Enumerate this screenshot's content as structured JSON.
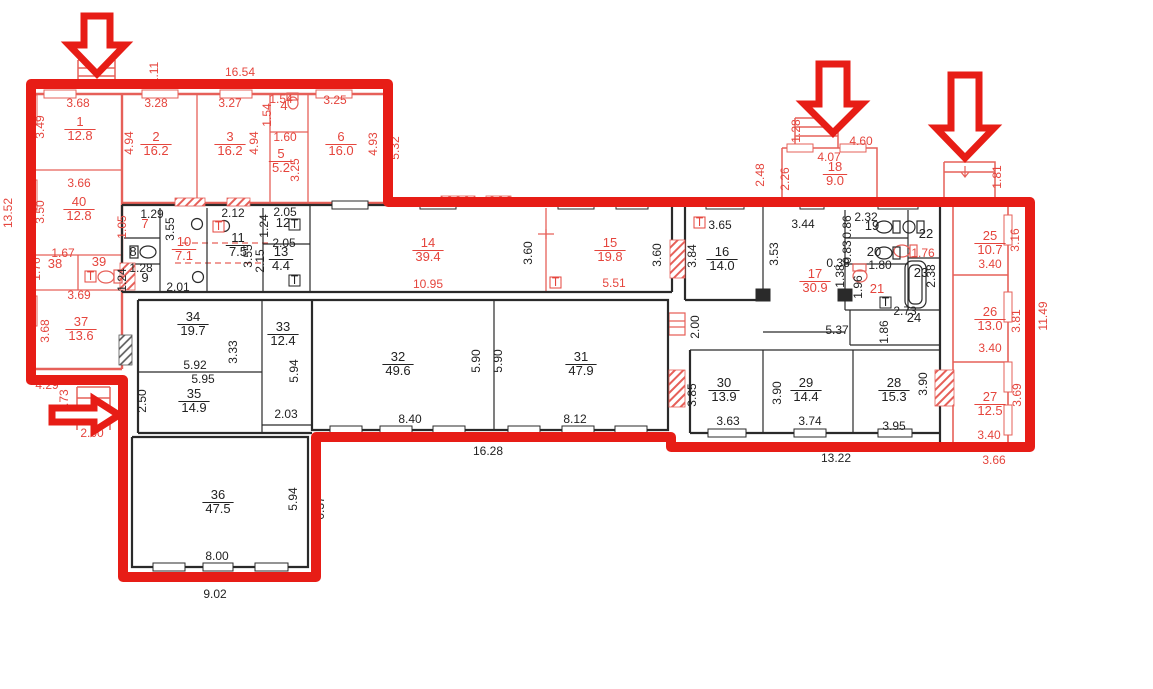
{
  "document": {
    "type": "apartment-building-floor-plan"
  },
  "colors": {
    "overlay_red": "#e71d16",
    "pen_red": "#e5453d",
    "wall_pink": "#e66059",
    "ink": "#222222",
    "background": "#ffffff"
  },
  "plan": {
    "rooms": [
      {
        "n": "1",
        "a": "12.8",
        "x": 80,
        "y": 126,
        "c": "r"
      },
      {
        "n": "2",
        "a": "16.2",
        "x": 156,
        "y": 141,
        "c": "r"
      },
      {
        "n": "3",
        "a": "16.2",
        "x": 230,
        "y": 141,
        "c": "r"
      },
      {
        "n": "4",
        "a": null,
        "x": 284,
        "y": 110,
        "c": "r"
      },
      {
        "n": "5",
        "a": "5.2",
        "x": 281,
        "y": 158,
        "c": "r"
      },
      {
        "n": "6",
        "a": "16.0",
        "x": 341,
        "y": 141,
        "c": "r"
      },
      {
        "n": "40",
        "a": "12.8",
        "x": 79,
        "y": 206,
        "c": "r"
      },
      {
        "n": "38",
        "a": null,
        "x": 55,
        "y": 268,
        "c": "r"
      },
      {
        "n": "39",
        "a": null,
        "x": 99,
        "y": 266,
        "c": "r"
      },
      {
        "n": "37",
        "a": "13.6",
        "x": 81,
        "y": 326,
        "c": "r"
      },
      {
        "n": "7",
        "a": null,
        "x": 145,
        "y": 228,
        "c": "r"
      },
      {
        "n": "8",
        "a": null,
        "x": 133,
        "y": 256,
        "c": "k"
      },
      {
        "n": "9",
        "a": null,
        "x": 145,
        "y": 282,
        "c": "k"
      },
      {
        "n": "10",
        "a": "7.1",
        "x": 184,
        "y": 246,
        "c": "r"
      },
      {
        "n": "11",
        "a": "7.5",
        "x": 238,
        "y": 242,
        "c": "k"
      },
      {
        "n": "12",
        "a": null,
        "x": 283,
        "y": 227,
        "c": "k"
      },
      {
        "n": "13",
        "a": "4.4",
        "x": 281,
        "y": 256,
        "c": "k"
      },
      {
        "n": "14",
        "a": "39.4",
        "x": 428,
        "y": 247,
        "c": "r"
      },
      {
        "n": "15",
        "a": "19.8",
        "x": 610,
        "y": 247,
        "c": "r"
      },
      {
        "n": "16",
        "a": "14.0",
        "x": 722,
        "y": 256,
        "c": "k"
      },
      {
        "n": "17",
        "a": "30.9",
        "x": 815,
        "y": 278,
        "c": "r"
      },
      {
        "n": "18",
        "a": "9.0",
        "x": 835,
        "y": 171,
        "c": "r"
      },
      {
        "n": "19",
        "a": null,
        "x": 872,
        "y": 230,
        "c": "k"
      },
      {
        "n": "20",
        "a": null,
        "x": 874,
        "y": 256,
        "c": "k"
      },
      {
        "n": "21",
        "a": null,
        "x": 877,
        "y": 293,
        "c": "r"
      },
      {
        "n": "22",
        "a": null,
        "x": 926,
        "y": 238,
        "c": "k"
      },
      {
        "n": "23",
        "a": null,
        "x": 921,
        "y": 277,
        "c": "k"
      },
      {
        "n": "24",
        "a": null,
        "x": 914,
        "y": 322,
        "c": "k"
      },
      {
        "n": "25",
        "a": "10.7",
        "x": 990,
        "y": 240,
        "c": "r"
      },
      {
        "n": "26",
        "a": "13.0",
        "x": 990,
        "y": 316,
        "c": "r"
      },
      {
        "n": "27",
        "a": "12.5",
        "x": 990,
        "y": 401,
        "c": "r"
      },
      {
        "n": "28",
        "a": "15.3",
        "x": 894,
        "y": 387,
        "c": "k"
      },
      {
        "n": "29",
        "a": "14.4",
        "x": 806,
        "y": 387,
        "c": "k"
      },
      {
        "n": "30",
        "a": "13.9",
        "x": 724,
        "y": 387,
        "c": "k"
      },
      {
        "n": "31",
        "a": "47.9",
        "x": 581,
        "y": 361,
        "c": "k"
      },
      {
        "n": "32",
        "a": "49.6",
        "x": 398,
        "y": 361,
        "c": "k"
      },
      {
        "n": "33",
        "a": "12.4",
        "x": 283,
        "y": 331,
        "c": "k"
      },
      {
        "n": "34",
        "a": "19.7",
        "x": 193,
        "y": 321,
        "c": "k"
      },
      {
        "n": "35",
        "a": "14.9",
        "x": 194,
        "y": 398,
        "c": "k"
      },
      {
        "n": "36",
        "a": "47.5",
        "x": 218,
        "y": 499,
        "c": "k"
      }
    ],
    "dims": [
      {
        "t": "16.54",
        "x": 240,
        "y": 76,
        "v": 0,
        "c": "r"
      },
      {
        "t": "1.11",
        "x": 158,
        "y": 73,
        "v": 1,
        "c": "r"
      },
      {
        "t": "13.52",
        "x": 12,
        "y": 213,
        "v": 1,
        "c": "r"
      },
      {
        "t": "3.68",
        "x": 78,
        "y": 107,
        "v": 0,
        "c": "r"
      },
      {
        "t": "3.49",
        "x": 44,
        "y": 127,
        "v": 1,
        "c": "r"
      },
      {
        "t": "3.28",
        "x": 156,
        "y": 107,
        "v": 0,
        "c": "r"
      },
      {
        "t": "4.94",
        "x": 133,
        "y": 143,
        "v": 1,
        "c": "r"
      },
      {
        "t": "3.27",
        "x": 230,
        "y": 107,
        "v": 0,
        "c": "r"
      },
      {
        "t": "4.94",
        "x": 258,
        "y": 143,
        "v": 1,
        "c": "r"
      },
      {
        "t": "1.54",
        "x": 281,
        "y": 103,
        "v": 0,
        "c": "r"
      },
      {
        "t": "1.54",
        "x": 271,
        "y": 115,
        "v": 1,
        "c": "r"
      },
      {
        "t": "1.60",
        "x": 285,
        "y": 141,
        "v": 0,
        "c": "r"
      },
      {
        "t": "3.25",
        "x": 299,
        "y": 170,
        "v": 1,
        "c": "r"
      },
      {
        "t": "3.25",
        "x": 335,
        "y": 104,
        "v": 0,
        "c": "r"
      },
      {
        "t": "4.93",
        "x": 377,
        "y": 144,
        "v": 1,
        "c": "r"
      },
      {
        "t": "5.32",
        "x": 399,
        "y": 148,
        "v": 1,
        "c": "r"
      },
      {
        "t": "3.66",
        "x": 79,
        "y": 187,
        "v": 0,
        "c": "r"
      },
      {
        "t": "3.50",
        "x": 44,
        "y": 212,
        "v": 1,
        "c": "r"
      },
      {
        "t": "1.67",
        "x": 63,
        "y": 257,
        "v": 0,
        "c": "r"
      },
      {
        "t": "1.76",
        "x": 40,
        "y": 269,
        "v": 1,
        "c": "r"
      },
      {
        "t": "3.69",
        "x": 79,
        "y": 299,
        "v": 0,
        "c": "r"
      },
      {
        "t": "3.68",
        "x": 49,
        "y": 331,
        "v": 1,
        "c": "r"
      },
      {
        "t": "4.29",
        "x": 47,
        "y": 389,
        "v": 0,
        "c": "r"
      },
      {
        "t": "1.73",
        "x": 68,
        "y": 401,
        "v": 1,
        "c": "r"
      },
      {
        "t": "2.00",
        "x": 92,
        "y": 437,
        "v": 0,
        "c": "r"
      },
      {
        "t": "1.05",
        "x": 126,
        "y": 227,
        "v": 1,
        "c": "r"
      },
      {
        "t": "10.95",
        "x": 428,
        "y": 288,
        "v": 0,
        "c": "r"
      },
      {
        "t": "5.51",
        "x": 614,
        "y": 287,
        "v": 0,
        "c": "r"
      },
      {
        "t": "2.48",
        "x": 764,
        "y": 175,
        "v": 1,
        "c": "r"
      },
      {
        "t": "2.26",
        "x": 789,
        "y": 179,
        "v": 1,
        "c": "r"
      },
      {
        "t": "1.28",
        "x": 800,
        "y": 131,
        "v": 1,
        "c": "r"
      },
      {
        "t": "4.60",
        "x": 861,
        "y": 145,
        "v": 0,
        "c": "r"
      },
      {
        "t": "4.07",
        "x": 829,
        "y": 161,
        "v": 0,
        "c": "r"
      },
      {
        "t": "1.81",
        "x": 1001,
        "y": 177,
        "v": 1,
        "c": "r"
      },
      {
        "t": "3.16",
        "x": 1019,
        "y": 240,
        "v": 1,
        "c": "r"
      },
      {
        "t": "3.40",
        "x": 990,
        "y": 268,
        "v": 0,
        "c": "r"
      },
      {
        "t": "3.81",
        "x": 1020,
        "y": 321,
        "v": 1,
        "c": "r"
      },
      {
        "t": "3.40",
        "x": 990,
        "y": 352,
        "v": 0,
        "c": "r"
      },
      {
        "t": "3.69",
        "x": 1021,
        "y": 395,
        "v": 1,
        "c": "r"
      },
      {
        "t": "3.40",
        "x": 989,
        "y": 439,
        "v": 0,
        "c": "r"
      },
      {
        "t": "3.66",
        "x": 994,
        "y": 464,
        "v": 0,
        "c": "r"
      },
      {
        "t": "11.49",
        "x": 1047,
        "y": 316,
        "v": 1,
        "c": "r"
      },
      {
        "t": "1.76",
        "x": 923,
        "y": 257,
        "v": 0,
        "c": "r"
      },
      {
        "t": "1.29",
        "x": 152,
        "y": 218,
        "v": 0,
        "c": "k"
      },
      {
        "t": "3.55",
        "x": 174,
        "y": 229,
        "v": 1,
        "c": "k"
      },
      {
        "t": "1.28",
        "x": 141,
        "y": 272,
        "v": 0,
        "c": "k"
      },
      {
        "t": "1.24",
        "x": 126,
        "y": 280,
        "v": 1,
        "c": "k"
      },
      {
        "t": "2.01",
        "x": 178,
        "y": 291,
        "v": 0,
        "c": "k"
      },
      {
        "t": "2.12",
        "x": 233,
        "y": 217,
        "v": 0,
        "c": "k"
      },
      {
        "t": "3.55",
        "x": 252,
        "y": 256,
        "v": 1,
        "c": "k"
      },
      {
        "t": "2.05",
        "x": 285,
        "y": 216,
        "v": 0,
        "c": "k"
      },
      {
        "t": "1.24",
        "x": 268,
        "y": 226,
        "v": 1,
        "c": "k"
      },
      {
        "t": "2.05",
        "x": 284,
        "y": 247,
        "v": 0,
        "c": "k"
      },
      {
        "t": "2.15",
        "x": 264,
        "y": 261,
        "v": 1,
        "c": "k"
      },
      {
        "t": "3.60",
        "x": 532,
        "y": 253,
        "v": 1,
        "c": "k"
      },
      {
        "t": "3.60",
        "x": 661,
        "y": 255,
        "v": 1,
        "c": "k"
      },
      {
        "t": "3.65",
        "x": 720,
        "y": 229,
        "v": 0,
        "c": "k"
      },
      {
        "t": "3.84",
        "x": 696,
        "y": 256,
        "v": 1,
        "c": "k"
      },
      {
        "t": "3.44",
        "x": 803,
        "y": 228,
        "v": 0,
        "c": "k"
      },
      {
        "t": "3.53",
        "x": 778,
        "y": 254,
        "v": 1,
        "c": "k"
      },
      {
        "t": "2.00",
        "x": 699,
        "y": 327,
        "v": 1,
        "c": "k"
      },
      {
        "t": "5.37",
        "x": 837,
        "y": 334,
        "v": 0,
        "c": "k"
      },
      {
        "t": "2.32",
        "x": 866,
        "y": 221,
        "v": 0,
        "c": "k"
      },
      {
        "t": "0.86",
        "x": 851,
        "y": 227,
        "v": 1,
        "c": "k"
      },
      {
        "t": "0.83",
        "x": 851,
        "y": 252,
        "v": 1,
        "c": "k"
      },
      {
        "t": "0.38",
        "x": 838,
        "y": 267,
        "v": 0,
        "c": "k"
      },
      {
        "t": "1.80",
        "x": 880,
        "y": 269,
        "v": 0,
        "c": "k"
      },
      {
        "t": "1.38",
        "x": 844,
        "y": 276,
        "v": 1,
        "c": "k"
      },
      {
        "t": "1.96",
        "x": 862,
        "y": 287,
        "v": 1,
        "c": "k"
      },
      {
        "t": "2.38",
        "x": 935,
        "y": 276,
        "v": 1,
        "c": "k"
      },
      {
        "t": "2.73",
        "x": 905,
        "y": 315,
        "v": 0,
        "c": "k"
      },
      {
        "t": "1.86",
        "x": 888,
        "y": 332,
        "v": 1,
        "c": "k"
      },
      {
        "t": "3.85",
        "x": 696,
        "y": 395,
        "v": 1,
        "c": "k"
      },
      {
        "t": "3.63",
        "x": 728,
        "y": 425,
        "v": 0,
        "c": "k"
      },
      {
        "t": "3.90",
        "x": 781,
        "y": 393,
        "v": 1,
        "c": "k"
      },
      {
        "t": "3.74",
        "x": 810,
        "y": 425,
        "v": 0,
        "c": "k"
      },
      {
        "t": "3.95",
        "x": 894,
        "y": 430,
        "v": 0,
        "c": "k"
      },
      {
        "t": "3.90",
        "x": 927,
        "y": 384,
        "v": 1,
        "c": "k"
      },
      {
        "t": "13.22",
        "x": 836,
        "y": 462,
        "v": 0,
        "c": "k"
      },
      {
        "t": "5.92",
        "x": 195,
        "y": 369,
        "v": 0,
        "c": "k"
      },
      {
        "t": "3.33",
        "x": 237,
        "y": 352,
        "v": 1,
        "c": "k"
      },
      {
        "t": "5.95",
        "x": 203,
        "y": 383,
        "v": 0,
        "c": "k"
      },
      {
        "t": "2.50",
        "x": 146,
        "y": 401,
        "v": 1,
        "c": "k"
      },
      {
        "t": "5.94",
        "x": 298,
        "y": 371,
        "v": 1,
        "c": "k"
      },
      {
        "t": "2.03",
        "x": 286,
        "y": 418,
        "v": 0,
        "c": "k"
      },
      {
        "t": "8.40",
        "x": 410,
        "y": 423,
        "v": 0,
        "c": "k"
      },
      {
        "t": "5.90",
        "x": 480,
        "y": 361,
        "v": 1,
        "c": "k"
      },
      {
        "t": "5.90",
        "x": 502,
        "y": 361,
        "v": 1,
        "c": "k"
      },
      {
        "t": "8.12",
        "x": 575,
        "y": 423,
        "v": 0,
        "c": "k"
      },
      {
        "t": "16.28",
        "x": 488,
        "y": 455,
        "v": 0,
        "c": "k"
      },
      {
        "t": "5.94",
        "x": 297,
        "y": 499,
        "v": 1,
        "c": "k"
      },
      {
        "t": "6.37",
        "x": 324,
        "y": 508,
        "v": 1,
        "c": "k"
      },
      {
        "t": "8.00",
        "x": 217,
        "y": 560,
        "v": 0,
        "c": "k"
      },
      {
        "t": "9.02",
        "x": 215,
        "y": 598,
        "v": 0,
        "c": "k"
      }
    ],
    "t_glyph": "T",
    "t_marks": [
      {
        "x": 85,
        "y": 271,
        "c": "r"
      },
      {
        "x": 550,
        "y": 277,
        "c": "r"
      },
      {
        "x": 213,
        "y": 221,
        "c": "r"
      },
      {
        "x": 694,
        "y": 217,
        "c": "r"
      },
      {
        "x": 289,
        "y": 219,
        "c": "k"
      },
      {
        "x": 289,
        "y": 275,
        "c": "k"
      },
      {
        "x": 880,
        "y": 297,
        "c": "k"
      }
    ]
  }
}
